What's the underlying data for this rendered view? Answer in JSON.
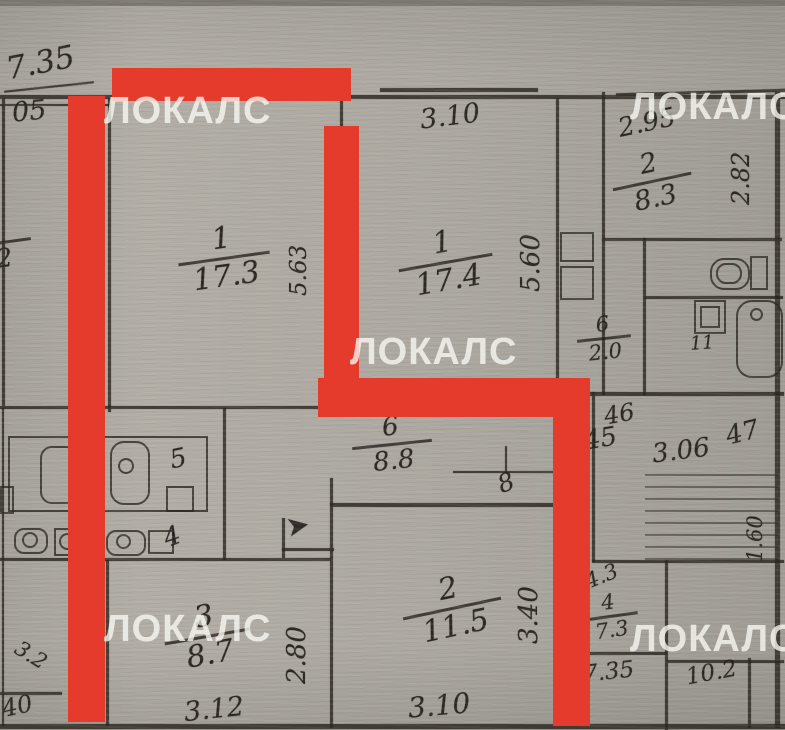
{
  "document_type": "apartment floor plan scan",
  "colors": {
    "paper": "#b2aea6",
    "ink": "#2c2721",
    "red_highlight": "#e43b2c",
    "watermark": "rgba(250,248,244,0.78)"
  },
  "watermark": {
    "text": "ЛОКАЛС",
    "positions": [
      {
        "x": 104,
        "y": 92
      },
      {
        "x": 630,
        "y": 88
      },
      {
        "x": 350,
        "y": 333
      },
      {
        "x": 104,
        "y": 610
      },
      {
        "x": 630,
        "y": 620
      }
    ]
  },
  "red_highlight": {
    "bars": [
      {
        "x": 112,
        "y": 68,
        "w": 239,
        "h": 33
      },
      {
        "x": 68,
        "y": 96,
        "w": 37,
        "h": 626
      },
      {
        "x": 324,
        "y": 126,
        "w": 35,
        "h": 290
      },
      {
        "x": 318,
        "y": 378,
        "w": 272,
        "h": 39
      },
      {
        "x": 553,
        "y": 378,
        "w": 37,
        "h": 348
      }
    ]
  },
  "rooms": [
    {
      "number": "1",
      "area": "17.3",
      "x": 178,
      "y": 224,
      "w": 92,
      "size": 30,
      "rot": -8
    },
    {
      "number": "1",
      "area": "17.4",
      "x": 398,
      "y": 228,
      "w": 95,
      "size": 30,
      "rot": -10
    },
    {
      "number": "2",
      "area": "8.3",
      "x": 612,
      "y": 150,
      "w": 80,
      "size": 27,
      "rot": -12
    },
    {
      "number": "6",
      "area": "8.8",
      "x": 352,
      "y": 414,
      "w": 80,
      "size": 26,
      "rot": -6
    },
    {
      "number": "2",
      "area": "11.5",
      "x": 402,
      "y": 574,
      "w": 100,
      "size": 30,
      "rot": -12
    },
    {
      "number": "3",
      "area": "8.7",
      "x": 164,
      "y": 602,
      "w": 86,
      "size": 30,
      "rot": -10
    },
    {
      "number": "6",
      "area": "2.0",
      "x": 577,
      "y": 314,
      "w": 54,
      "size": 21,
      "rot": -6
    },
    {
      "number": "4",
      "area": "7.3",
      "x": 582,
      "y": 592,
      "w": 56,
      "size": 21,
      "rot": -8
    },
    {
      "number": "",
      "area": "2",
      "x": -26,
      "y": 226,
      "w": 58,
      "size": 26,
      "rot": -8
    }
  ],
  "dimensions": [
    {
      "text": "7.35",
      "x": 6,
      "y": 48,
      "size": 31,
      "rot": -11
    },
    {
      "text": "05",
      "x": 12,
      "y": 98,
      "size": 27,
      "rot": -6
    },
    {
      "text": "3.10",
      "x": 420,
      "y": 103,
      "size": 27,
      "rot": -7
    },
    {
      "text": "2.95",
      "x": 618,
      "y": 110,
      "size": 26,
      "rot": -12
    },
    {
      "text": "46",
      "x": 604,
      "y": 402,
      "size": 24,
      "rot": -10
    },
    {
      "text": "45",
      "x": 584,
      "y": 426,
      "size": 26,
      "rot": -10
    },
    {
      "text": "3.06",
      "x": 652,
      "y": 438,
      "size": 26,
      "rot": -7
    },
    {
      "text": "47",
      "x": 726,
      "y": 420,
      "size": 26,
      "rot": -14
    },
    {
      "text": "3.12",
      "x": 184,
      "y": 696,
      "size": 27,
      "rot": -6
    },
    {
      "text": "3.10",
      "x": 408,
      "y": 692,
      "size": 28,
      "rot": -5
    },
    {
      "text": "4.3",
      "x": 585,
      "y": 566,
      "size": 21,
      "rot": -22
    },
    {
      "text": "7.35",
      "x": 583,
      "y": 661,
      "size": 23,
      "rot": -6
    },
    {
      "text": "10.2",
      "x": 686,
      "y": 662,
      "size": 23,
      "rot": -10
    }
  ],
  "vertical_dimensions": [
    {
      "text": "2.82",
      "x": 729,
      "y": 205,
      "size": 24
    },
    {
      "text": "5.63",
      "x": 288,
      "y": 296,
      "size": 23
    },
    {
      "text": "5.60",
      "x": 518,
      "y": 292,
      "size": 26
    },
    {
      "text": "2.80",
      "x": 284,
      "y": 684,
      "size": 26
    },
    {
      "text": "3.40",
      "x": 516,
      "y": 644,
      "size": 26
    },
    {
      "text": "1.60",
      "x": 745,
      "y": 562,
      "size": 21
    }
  ],
  "labels": [
    {
      "text": "5",
      "x": 170,
      "y": 446,
      "size": 26,
      "rot": -12
    },
    {
      "text": "4",
      "x": 164,
      "y": 524,
      "size": 26,
      "rot": -20
    },
    {
      "text": "8",
      "x": 498,
      "y": 470,
      "size": 25,
      "rot": -20
    },
    {
      "text": "11",
      "x": 690,
      "y": 334,
      "size": 19,
      "rot": -4
    },
    {
      "text": "40",
      "x": 2,
      "y": 694,
      "size": 24,
      "rot": -12
    },
    {
      "text": "3.2",
      "x": 14,
      "y": 645,
      "size": 21,
      "rot": 32
    }
  ],
  "entrance_arrow": {
    "glyph": "➤",
    "x": 286,
    "y": 512,
    "size": 28,
    "rot": -10
  },
  "walls": [
    [
      0,
      95,
      785,
      4
    ],
    [
      0,
      104,
      110,
      2
    ],
    [
      380,
      88,
      158,
      4
    ],
    [
      616,
      91,
      170,
      3,
      -1.5
    ],
    [
      775,
      92,
      5,
      636
    ],
    [
      108,
      98,
      3,
      314
    ],
    [
      340,
      98,
      3,
      312
    ],
    [
      556,
      98,
      3,
      297
    ],
    [
      602,
      92,
      3,
      303
    ],
    [
      643,
      238,
      3,
      157
    ],
    [
      602,
      238,
      180,
      3
    ],
    [
      645,
      296,
      138,
      3
    ],
    [
      556,
      392,
      228,
      4
    ],
    [
      0,
      406,
      344,
      3
    ],
    [
      345,
      387,
      213,
      3
    ],
    [
      223,
      408,
      3,
      152
    ],
    [
      330,
      478,
      3,
      250
    ],
    [
      0,
      558,
      331,
      3
    ],
    [
      330,
      503,
      228,
      4
    ],
    [
      592,
      392,
      3,
      170
    ],
    [
      592,
      560,
      192,
      3
    ],
    [
      665,
      560,
      3,
      170
    ],
    [
      560,
      652,
      106,
      3
    ],
    [
      667,
      660,
      117,
      3
    ],
    [
      748,
      658,
      3,
      70
    ],
    [
      0,
      724,
      785,
      5
    ],
    [
      2,
      98,
      3,
      308
    ],
    [
      106,
      560,
      3,
      166
    ],
    [
      0,
      692,
      62,
      3
    ],
    [
      282,
      518,
      3,
      40
    ],
    [
      282,
      548,
      52,
      3
    ],
    [
      2,
      408,
      2,
      318
    ],
    [
      453,
      471,
      105,
      2
    ],
    [
      505,
      446,
      2,
      27
    ],
    [
      4,
      86,
      90,
      2,
      -6
    ]
  ],
  "fixtures": [
    {
      "type": "rect",
      "x": 8,
      "y": 436,
      "w": 200,
      "h": 76,
      "name": "kitchen-counter"
    },
    {
      "type": "round",
      "x": 40,
      "y": 446,
      "w": 38,
      "h": 58,
      "r": 12,
      "name": "kitchen-sink-fixture"
    },
    {
      "type": "round",
      "x": 110,
      "y": 441,
      "w": 40,
      "h": 64,
      "r": 14,
      "name": "stove-fixture"
    },
    {
      "type": "circle",
      "x": 118,
      "y": 458,
      "w": 16,
      "h": 16,
      "name": "stove-burner"
    },
    {
      "type": "rect",
      "x": 166,
      "y": 486,
      "w": 28,
      "h": 26,
      "name": "kitchen-box"
    },
    {
      "type": "rect",
      "x": 0,
      "y": 486,
      "w": 14,
      "h": 28,
      "name": "kitchen-box-small"
    },
    {
      "type": "round",
      "x": 14,
      "y": 528,
      "w": 34,
      "h": 26,
      "r": 10,
      "name": "appliance-oval"
    },
    {
      "type": "circle",
      "x": 22,
      "y": 532,
      "w": 16,
      "h": 16,
      "name": "appliance-dial"
    },
    {
      "type": "rect",
      "x": 54,
      "y": 528,
      "w": 48,
      "h": 28,
      "name": "appliance-box"
    },
    {
      "type": "circle",
      "x": 59,
      "y": 533,
      "w": 17,
      "h": 17,
      "name": "appliance-dial"
    },
    {
      "type": "circle",
      "x": 79,
      "y": 533,
      "w": 17,
      "h": 17,
      "name": "appliance-dial"
    },
    {
      "type": "round",
      "x": 106,
      "y": 530,
      "w": 40,
      "h": 26,
      "r": 10,
      "name": "appliance-oval"
    },
    {
      "type": "circle",
      "x": 116,
      "y": 534,
      "w": 15,
      "h": 15,
      "name": "appliance-dial"
    },
    {
      "type": "rect",
      "x": 148,
      "y": 530,
      "w": 26,
      "h": 24,
      "name": "appliance-box"
    },
    {
      "type": "round",
      "x": 736,
      "y": 300,
      "w": 47,
      "h": 78,
      "r": 16,
      "name": "bathtub-fixture"
    },
    {
      "type": "circle",
      "x": 750,
      "y": 308,
      "w": 13,
      "h": 13,
      "name": "bathtub-drain"
    },
    {
      "type": "rect",
      "x": 750,
      "y": 256,
      "w": 18,
      "h": 34,
      "name": "toilet-tank"
    },
    {
      "type": "round",
      "x": 710,
      "y": 258,
      "w": 40,
      "h": 32,
      "r": 14,
      "name": "toilet-bowl"
    },
    {
      "type": "round",
      "x": 716,
      "y": 263,
      "w": 26,
      "h": 21,
      "r": 10,
      "name": "toilet-bowl-inner"
    },
    {
      "type": "rect",
      "x": 694,
      "y": 300,
      "w": 32,
      "h": 34,
      "name": "bath-sink-fixture"
    },
    {
      "type": "rect",
      "x": 700,
      "y": 306,
      "w": 20,
      "h": 22,
      "name": "bath-sink-inner"
    },
    {
      "type": "rect",
      "x": 560,
      "y": 232,
      "w": 34,
      "h": 30,
      "name": "closet-box"
    },
    {
      "type": "rect",
      "x": 560,
      "y": 266,
      "w": 34,
      "h": 34,
      "name": "closet-box"
    }
  ],
  "stairs": {
    "x": 645,
    "w": 133,
    "y_start": 474,
    "step": 12,
    "count": 8
  }
}
